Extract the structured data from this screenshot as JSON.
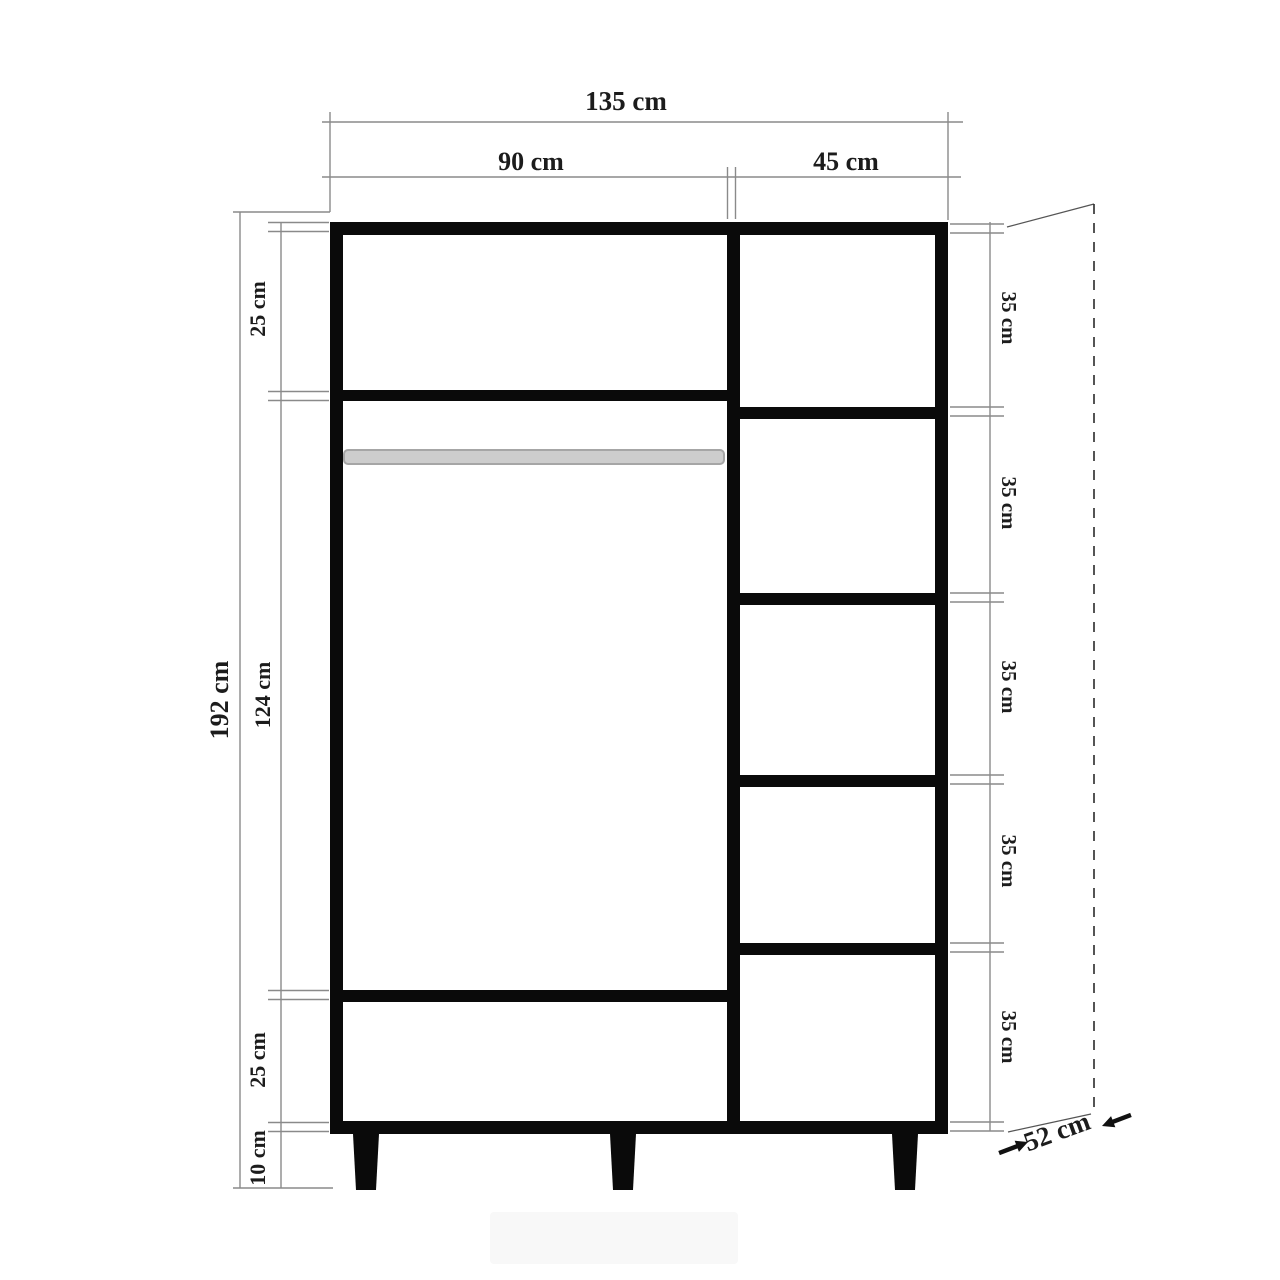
{
  "diagram": {
    "type": "furniture-technical-drawing",
    "subject": "wardrobe front elevation with dimension annotations",
    "unit": "cm",
    "top_dimensions": {
      "total_width": "135 cm",
      "left_compartment_width": "90 cm",
      "right_compartment_width": "45 cm"
    },
    "left_dimensions": {
      "total_height": "192 cm",
      "top_section": "25 cm",
      "middle_section": "124 cm",
      "bottom_section": "25 cm",
      "leg_height": "10 cm"
    },
    "right_dimensions": {
      "shelf_sections": [
        "35 cm",
        "35 cm",
        "35 cm",
        "35 cm",
        "35 cm"
      ]
    },
    "depth_dimension": "52 cm",
    "colors": {
      "background": "#ffffff",
      "cabinet": "#0a0a0a",
      "dimension_line": "#8a8a8a",
      "text": "#1c1c1c",
      "rod_fill": "#cdcdcd"
    }
  }
}
